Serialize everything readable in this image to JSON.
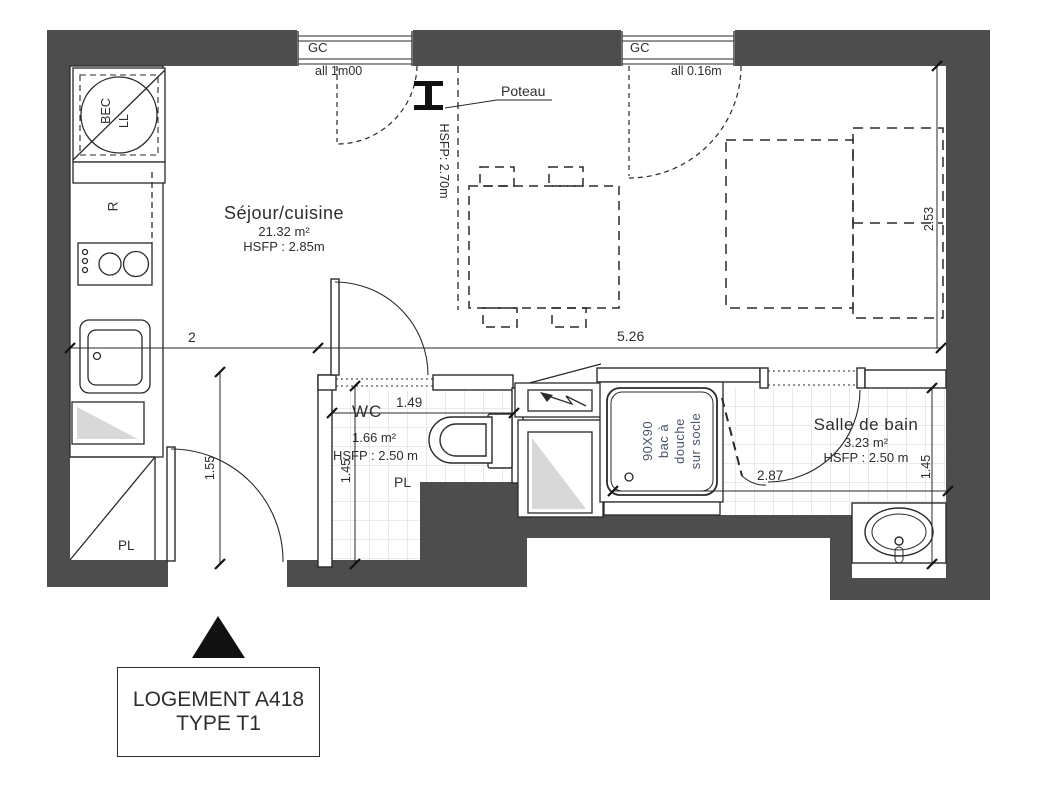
{
  "title_block": {
    "line1": "LOGEMENT A418",
    "line2": "TYPE T1"
  },
  "rooms": {
    "sejour": {
      "name": "Séjour/cuisine",
      "area": "21.32 m²",
      "hsfp": "HSFP : 2.85m"
    },
    "wc": {
      "name": "WC",
      "area": "1.66 m²",
      "hsfp": "HSFP : 2.50 m",
      "pl": "PL"
    },
    "sdb": {
      "name": "Salle de bain",
      "area": "3.23 m²",
      "hsfp": "HSFP : 2.50 m"
    }
  },
  "windows": {
    "w1": {
      "label": "GC",
      "sill": "all 1m00"
    },
    "w2": {
      "label": "GC",
      "sill": "all 0.16m"
    }
  },
  "column": {
    "label": "Poteau",
    "hsfp": "HSFP: 2.70m"
  },
  "kitchen": {
    "bec": "BEC",
    "ll": "LL",
    "fridge": "R",
    "closet": "PL"
  },
  "shower": {
    "lines": [
      "90X90",
      "bac à",
      "douche",
      "sur socle"
    ]
  },
  "dimensions": {
    "kitchen_width": "2",
    "living_width": "5.26",
    "bed_depth": "2.53",
    "entry_depth": "1.55",
    "wc_width": "1.49",
    "wc_depth": "1.45",
    "sdb_width": "2.87",
    "sdb_depth": "1.45"
  },
  "colors": {
    "wall": "#4d4d4d",
    "line": "#2a2a2a",
    "text": "#2e2e2e",
    "shower_text": "#4a5565",
    "tile": "#e9e9e9",
    "fill_gray": "#d8d8d8"
  }
}
